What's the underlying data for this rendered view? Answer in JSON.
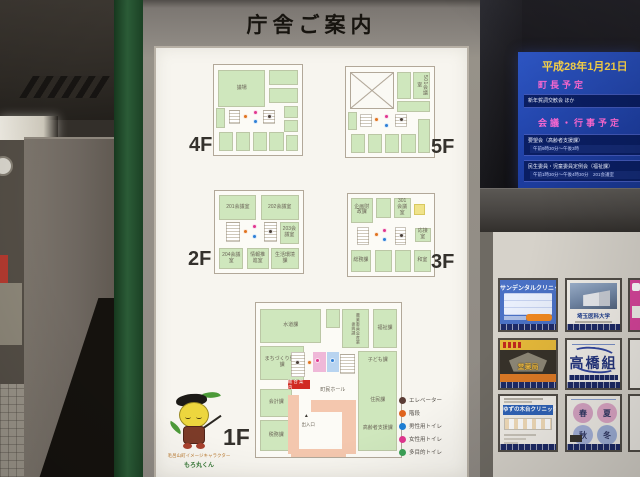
{
  "board": {
    "title": "庁舎ご案内",
    "floors": {
      "f4": {
        "label": "4F",
        "rooms": {
          "main": "議場"
        }
      },
      "f5": {
        "label": "5F",
        "rooms": {
          "r501": "501会議室"
        }
      },
      "f2": {
        "label": "2F",
        "rooms": {
          "r201": "201会議室",
          "r202": "202会議室",
          "r203": "203会議室",
          "r204": "204会議室",
          "info": "情報推進室",
          "seikatsu": "生活環境課"
        }
      },
      "f3": {
        "label": "3F",
        "rooms": {
          "kikaku": "企画財政課",
          "r301": "301会議室",
          "osetsu": "応接室",
          "somu": "総務課",
          "washitsu": "和室"
        }
      },
      "f1": {
        "label": "1F",
        "rooms": {
          "suido": "水道課",
          "machi": "まちづくり整備課",
          "kaikei": "会計課",
          "zeimu": "税務課",
          "nogyo": "農業委員会産業振興課",
          "fukushi": "福祉課",
          "kodomo": "子ども課",
          "jumin": "住民課",
          "korei": "高齢者支援課",
          "hall": "町民ホール",
          "uketsuke": "総合案内",
          "entrance": "出入口"
        }
      }
    },
    "legend": [
      {
        "label": "エレベーター",
        "color": "#5a3c34"
      },
      {
        "label": "階段",
        "color": "#e0641e"
      },
      {
        "label": "男性用トイレ",
        "color": "#1f7fd4"
      },
      {
        "label": "女性用トイレ",
        "color": "#e0368e"
      },
      {
        "label": "多目的トイレ",
        "color": "#3aa055"
      }
    ],
    "mascot": {
      "caption1": "毛呂山町イメージキャラクター",
      "caption2": "もろ丸くん"
    }
  },
  "display": {
    "date": "平成28年1月21日",
    "mayor_title": "町長予定",
    "mayor_event": "新年賀詞交歓会 ほか",
    "events_title": "会議・行事予定",
    "event1_title": "要望会（高齢者支援課）",
    "event1_time": "午前9時30分～午後3時",
    "event2_title": "民生委員・児童委員定例会（福祉課）",
    "event2_time": "午前1時30分～午後4時30分　201会議室"
  },
  "ads": {
    "a1": {
      "title": "サンデンタルクリニック"
    },
    "a2": {
      "title": "埼玉医科大学"
    },
    "a4": {
      "title": "堂薬局"
    },
    "a5": {
      "title": "高橋組"
    },
    "a7": {
      "title": "ゆずの木台クリニック"
    },
    "a8": {
      "chars": [
        "春",
        "夏",
        "秋",
        "冬"
      ]
    }
  }
}
